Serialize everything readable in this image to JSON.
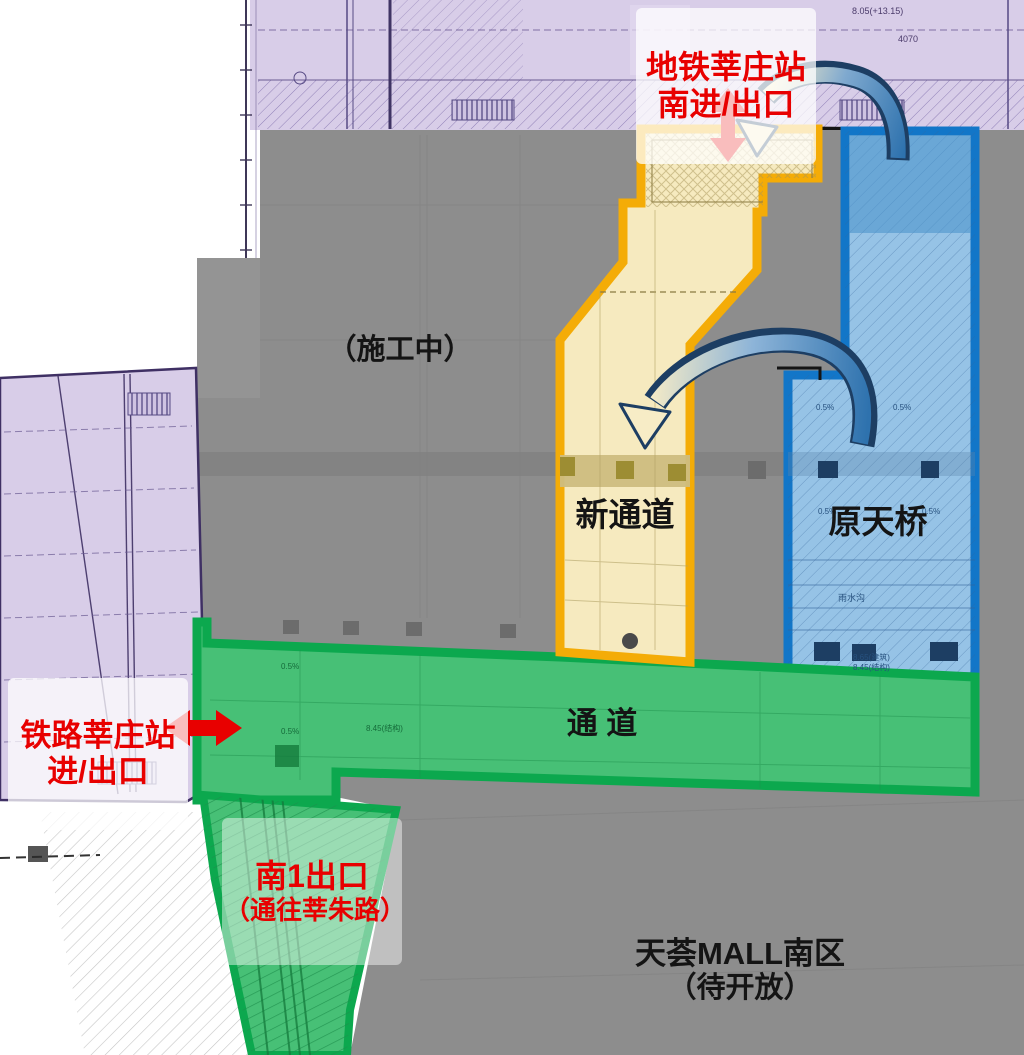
{
  "labels": {
    "metro_station": {
      "line1": "地铁莘庄站",
      "line2": "南进/出口"
    },
    "construction": "（施工中）",
    "new_passage": "新通道",
    "old_bridge": "原天桥",
    "passage": "通  道",
    "railway_station": {
      "line1": "铁路莘庄站",
      "line2": "进/出口"
    },
    "south_exit": {
      "line1": "南1出口",
      "line2": "（通往莘朱路）"
    },
    "mall": {
      "line1": "天荟MALL南区",
      "line2": "（待开放）"
    }
  },
  "annotations": [
    {
      "text": "8.05(+13.15)"
    },
    {
      "text": "4070"
    },
    {
      "text": "0.5%"
    },
    {
      "text": "0.5%"
    },
    {
      "text": "0.5%"
    },
    {
      "text": "0.5%"
    },
    {
      "text": "雨水沟"
    },
    {
      "text": "8.65(建筑)"
    },
    {
      "text": "8.45(结构)"
    },
    {
      "text": "8.45(结构)"
    },
    {
      "text": "0.5%"
    },
    {
      "text": "0.5%"
    }
  ],
  "icons": {
    "red_double_arrow_vertical": "metro-entrance-direction",
    "red_double_arrow_horizontal": "railway-entrance-direction",
    "curved_arrow_top": "route-from-metro-exit-to-new-passage",
    "curved_arrow_middle": "route-from-old-bridge-to-new-passage"
  },
  "colors": {
    "red": "#e80000",
    "yellow_border": "#f4ac07",
    "yellow_fill": "#f6eabf",
    "blue_border": "#1276c8",
    "blue_fill": "#96c3e6",
    "green_border": "#0ca84e",
    "green_fill": "#47c076",
    "gray_fill": "#8d8d8d",
    "purple_fill": "#d8cde8",
    "navy": "#1d3e63"
  }
}
